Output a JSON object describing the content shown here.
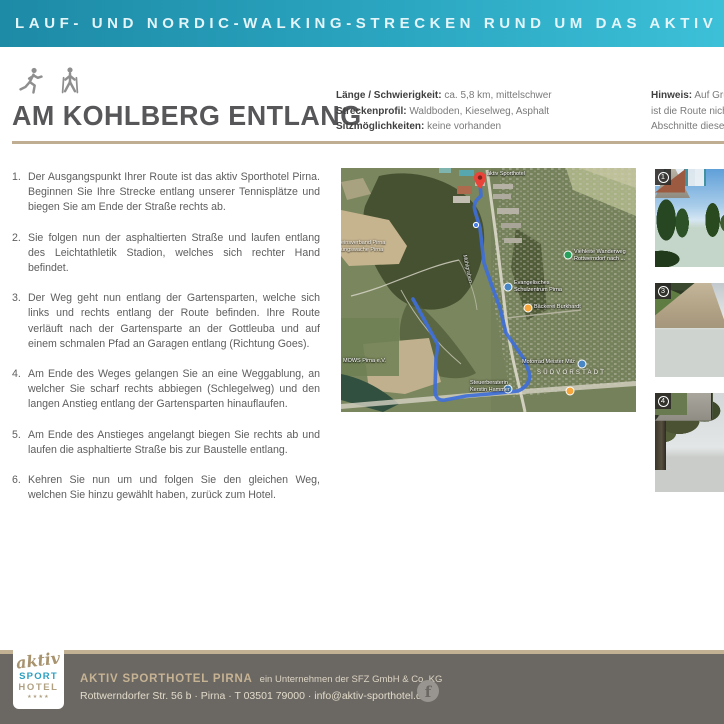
{
  "header": {
    "title": "LAUF- UND NORDIC-WALKING-STRECKEN RUND UM DAS AKTIV SPORTHOTEL"
  },
  "route": {
    "title": "AM KOHLBERG ENTLANG",
    "facts": [
      {
        "label": "Länge / Schwierigkeit:",
        "value": "ca. 5,8 km, mittelschwer"
      },
      {
        "label": "Streckenprofil:",
        "value": "Waldboden, Kieselweg, Asphalt"
      },
      {
        "label": "Sitzmöglichkeiten:",
        "value": "keine vorhanden"
      }
    ],
    "hinweis": {
      "label": "Hinweis:",
      "line1": "Auf Grun",
      "line2": "ist die Route nicht",
      "line3": "Abschnitte dieser"
    }
  },
  "directions": [
    {
      "num": "1.",
      "text": "Der Ausgangspunkt Ihrer Route ist das aktiv Sporthotel Pirna. Beginnen Sie Ihre Strecke entlang unserer Tennisplätze und biegen Sie am Ende der Straße rechts ab."
    },
    {
      "num": "2.",
      "text": "Sie folgen nun der asphaltierten Straße und laufen entlang des Leichtathletik Stadion, welches sich rechter Hand befindet."
    },
    {
      "num": "3.",
      "text": "Der Weg geht nun entlang der Gartensparten, welche sich links und rechts entlang der Route befinden. Ihre Route verläuft nach der Gartensparte an der Gottleuba und auf einem schmalen Pfad an Garagen entlang (Richtung Goes)."
    },
    {
      "num": "4.",
      "text": "Am Ende des Weges gelangen Sie an eine Weggablung, an welcher Sie scharf rechts abbiegen (Schlegelweg) und den langen Anstieg entlang der Gartensparten hinauflaufen."
    },
    {
      "num": "5.",
      "text": "Am Ende des Anstieges angelangt biegen Sie rechts ab und laufen die asphaltierte Straße bis zur Baustelle entlang."
    },
    {
      "num": "6.",
      "text": "Kehren Sie nun um und folgen Sie den gleichen Weg, welchen Sie hinzu gewählt haben, zurück zum Hotel."
    }
  ],
  "map": {
    "marker_label": "aktiv Sporthotel",
    "poi": {
      "viehleite1": "Viehleite Wanderweg",
      "viehleite2": "Rottwerndorf nach ...",
      "schule1": "Evangelisches",
      "schule2": "Schulzentrum Pirna",
      "baeckerei": "Bäckerei Burkhardt",
      "mows": "MOWS Pirna e.V.",
      "motorrad": "Motorrad Meister Milz",
      "district": "SÜDVORSTADT",
      "steuer1": "Steuerberaterin",
      "steuer2": "Kerstin Hammer",
      "stream": "Mühlgraben",
      "left1": "einsverband Pirna",
      "left2": "ungswache Pirna"
    }
  },
  "photos": {
    "badge1": "1",
    "badge2": "3",
    "badge3": "4"
  },
  "footer": {
    "logo_script": "aktiv",
    "logo_sport": "SPORT",
    "logo_hotel": "HOTEL",
    "logo_stars": "★★★★",
    "company": "AKTIV SPORTHOTEL PIRNA",
    "company_suffix": "ein Unternehmen der SFZ GmbH & Co. KG",
    "address": "Rottwerndorfer Str. 56 b · Pirna · T 03501 79000 · info@aktiv-sporthotel.de",
    "facebook_glyph": "f"
  },
  "colors": {
    "accent_teal": "#2ba6c1",
    "tan": "#c2b193",
    "footer_bg": "#6b6762",
    "route_blue": "#3f6fd8"
  }
}
